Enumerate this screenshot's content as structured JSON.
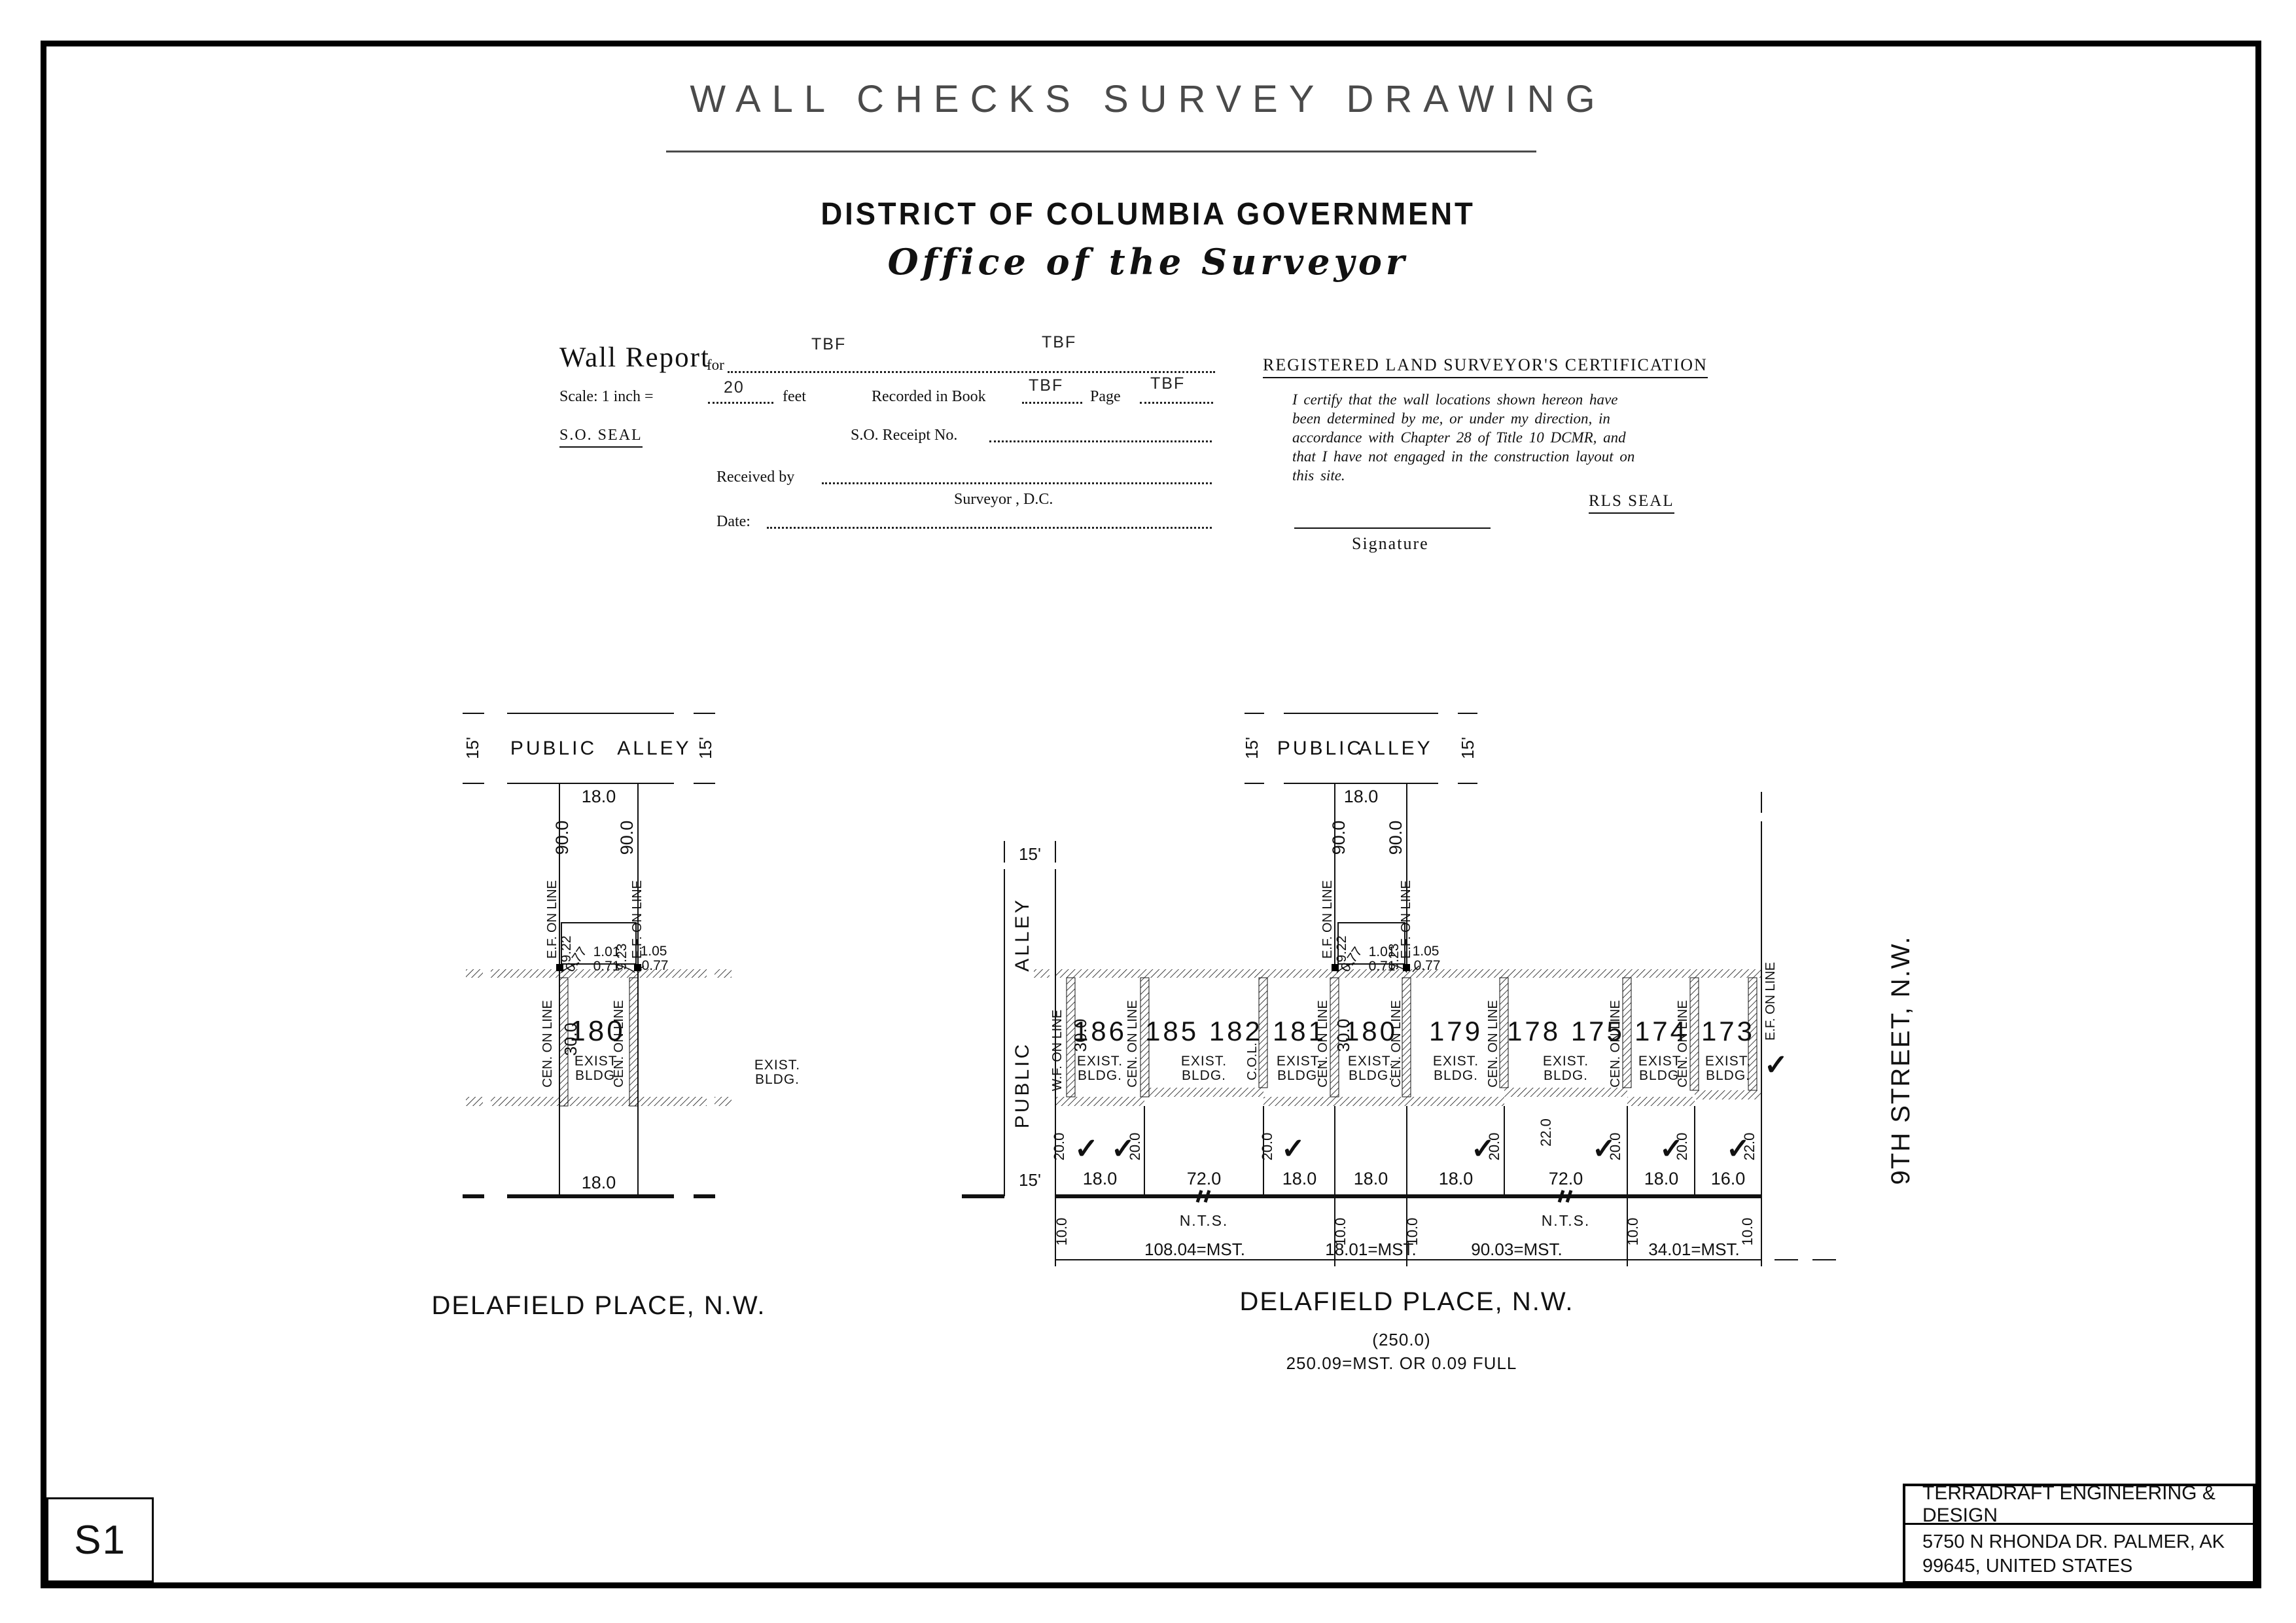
{
  "header": {
    "title": "WALL CHECKS SURVEY DRAWING",
    "government": "DISTRICT OF COLUMBIA GOVERNMENT",
    "office": "Office of the Surveyor"
  },
  "form": {
    "wall_report": "Wall Report",
    "for_label": "for",
    "for_value_1": "TBF",
    "for_value_2": "TBF",
    "scale_label": "Scale: 1 inch =",
    "scale_value": "20",
    "feet_label": "feet",
    "recorded_label": "Recorded in Book",
    "book_value": "TBF",
    "page_label": "Page",
    "page_value": "TBF",
    "so_seal": "S.O. SEAL",
    "receipt_label": "S.O. Receipt No.",
    "received_label": "Received by",
    "surveyor_line": "Surveyor , D.C.",
    "date_label": "Date:"
  },
  "certification": {
    "heading": "REGISTERED LAND SURVEYOR'S CERTIFICATION",
    "body": "I certify that the wall locations shown hereon have been determined by me, or under my direction, in accordance with Chapter 28 of Title 10 DCMR, and that I have not engaged in the construction layout on this site.",
    "rls_seal": "RLS SEAL",
    "signature": "Signature"
  },
  "left_plat": {
    "width_15": "15'",
    "public": "PUBLIC",
    "alley": "ALLEY",
    "alley_frontage": "18.0",
    "depth_90": "90.0",
    "ef_on_line": "E.F. ON LINE",
    "d_922": "9.22",
    "d_077a": "0.77",
    "d_101": "1.01",
    "d_071": "0.71",
    "d_923": "9.23",
    "d_105": "1.05",
    "d_077b": "0.77",
    "cen_on_line": "CEN. ON LINE",
    "depth_30": "30.0",
    "lot": "180",
    "exist1": "EXIST.",
    "exist2": "BLDG.",
    "frontage": "18.0",
    "street": "DELAFIELD  PLACE, N.W."
  },
  "right_plat": {
    "width_15": "15'",
    "public": "PUBLIC",
    "alley": "ALLEY",
    "alley_frontage": "18.0",
    "depth_90": "90.0",
    "ef_on_line": "E.F. ON LINE",
    "d_922": "9.22",
    "d_077a": "0.77",
    "d_101": "1.01",
    "d_071": "0.71",
    "d_923": "9.23",
    "d_105": "1.05",
    "d_077b": "0.77",
    "cen_on_line": "CEN. ON LINE",
    "col": "C.O.L.",
    "wf_on_line": "W.F. ON LINE",
    "depth_30": "30.0",
    "exist1": "EXIST.",
    "exist2": "BLDG.",
    "dim_20": "20.0",
    "dim_22": "22.0",
    "nts": "N.T.S.",
    "offset_10": "10.0",
    "lots": [
      {
        "id": "186",
        "frontage": "18.0"
      },
      {
        "id": "185 182",
        "frontage": "72.0"
      },
      {
        "id": "181",
        "frontage": "18.0"
      },
      {
        "id": "180",
        "frontage": "18.0"
      },
      {
        "id": "179",
        "frontage": "18.0"
      },
      {
        "id": "178 175",
        "frontage": "72.0"
      },
      {
        "id": "174",
        "frontage": "18.0"
      },
      {
        "id": "173",
        "frontage": "16.0"
      }
    ],
    "msts": [
      "108.04=MST.",
      "18.01=MST.",
      "90.03=MST.",
      "34.01=MST."
    ],
    "street": "DELAFIELD  PLACE, N.W.",
    "street_paren": "(250.0)",
    "street_total": "250.09=MST. OR 0.09 FULL",
    "ninth_street": "9TH  STREET, N.W."
  },
  "footer": {
    "sheet": "S1",
    "company": "TERRADRAFT ENGINEERING & DESIGN",
    "address_line1": "5750 N RHONDA DR. PALMER, AK",
    "address_line2": "99645, UNITED STATES"
  },
  "symbols": {
    "check": "✓"
  }
}
